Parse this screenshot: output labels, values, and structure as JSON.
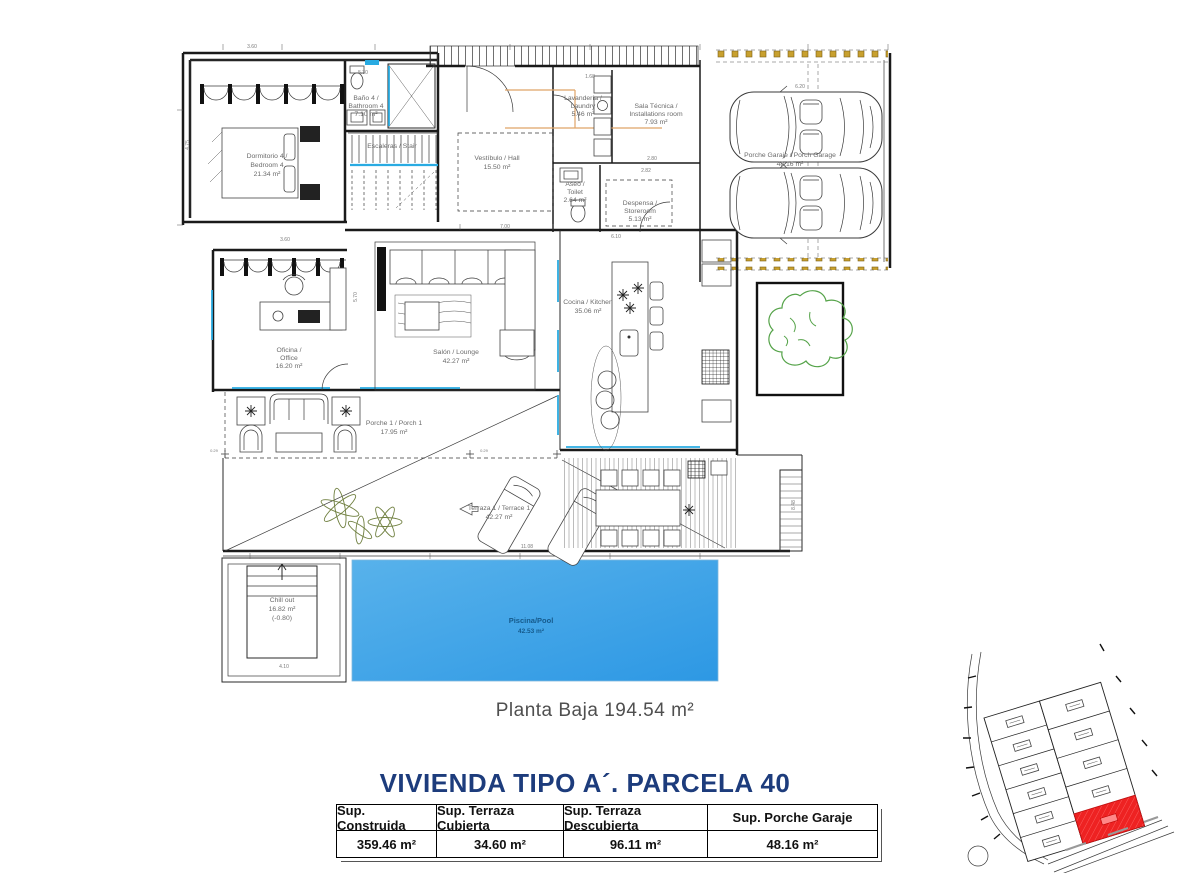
{
  "colors": {
    "wall": "#1a1a1a",
    "label_gray": "#6b6b6b",
    "glazing_cyan": "#29abe2",
    "pool_blue_light": "#55b0ea",
    "pool_blue_dark": "#2d98e4",
    "pool_text_blue": "#155a8c",
    "tree_green": "#55a349",
    "plant_olive": "#6f7f3f",
    "pergola_gold": "#c8a02e",
    "beam_orange": "#dfa468",
    "heading_blue": "#1d3c7c",
    "parcel_red": "#ee2222",
    "title_gray": "#4f4f4f"
  },
  "plan": {
    "rooms": {
      "bedroom4": {
        "l1": "Dormitorio 4 /",
        "l2": "Bedroom 4",
        "l3": "21.34 m²"
      },
      "bathroom4": {
        "l1": "Baño 4 /",
        "l2": "Bathroom 4",
        "l3": "7.10 m²"
      },
      "stairs": {
        "l1": "Escaleras / Stair"
      },
      "hall": {
        "l1": "Vestíbulo / Hall",
        "l2": "15.50 m²"
      },
      "laundry": {
        "l1": "Lavandería /",
        "l2": "Laundry",
        "l3": "5.46 m²"
      },
      "toilet": {
        "l1": "Aseo /",
        "l2": "Toilet",
        "l3": "2.64 m²"
      },
      "installations": {
        "l1": "Sala Técnica /",
        "l2": "Installations room",
        "l3": "7.93 m²"
      },
      "storeroom": {
        "l1": "Despensa /",
        "l2": "Storeroom",
        "l3": "5.13 m²"
      },
      "garage": {
        "l1": "Porche Garaje / Porch Garage",
        "l2": "48.16 m²"
      },
      "office": {
        "l1": "Oficina /",
        "l2": "Office",
        "l3": "16.20 m²"
      },
      "lounge": {
        "l1": "Salón / Lounge",
        "l2": "42.27 m²"
      },
      "kitchen": {
        "l1": "Cocina / Kitchen",
        "l2": "35.06 m²"
      },
      "porch1": {
        "l1": "Porche 1 / Porch 1",
        "l2": "17.95 m²"
      },
      "terrace1": {
        "l1": "Terraza 1 / Terrace 1",
        "l2": "42.27 m²"
      },
      "chillout": {
        "l1": "Chill out",
        "l2": "16.82 m²",
        "l3": "(-0.80)"
      },
      "pool": {
        "l1": "Piscina/Pool",
        "l2": "42.53 m²"
      }
    },
    "dims": [
      "3.60",
      "5.30",
      "4.75",
      "1.68",
      "6.20",
      "2.80",
      "2.82",
      "6.10",
      "7.00",
      "3.60",
      "11.08",
      "4.10",
      "8.48",
      "0.29",
      "0.29",
      "5.70"
    ]
  },
  "footer": {
    "plan_title": "Planta Baja 194.54 m²",
    "heading": "VIVIENDA TIPO A´. PARCELA 40",
    "table": {
      "headers": [
        "Sup. Construida",
        "Sup. Terraza Cubierta",
        "Sup. Terraza Descubierta",
        "Sup. Porche Garaje"
      ],
      "values": [
        "359.46 m²",
        "34.60 m²",
        "96.11 m²",
        "48.16 m²"
      ]
    }
  }
}
